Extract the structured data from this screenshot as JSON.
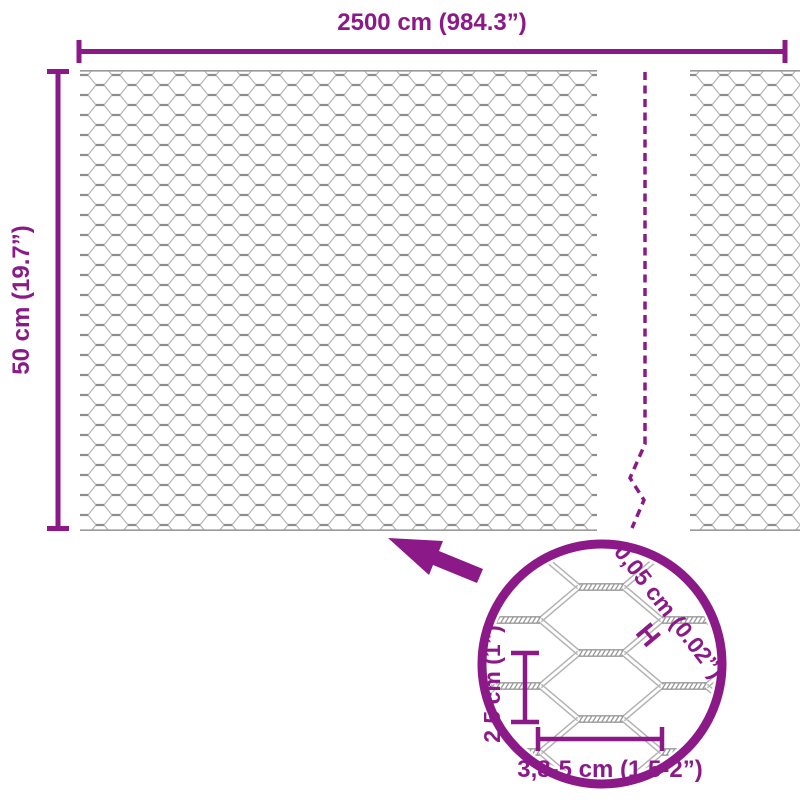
{
  "colors": {
    "accent": "#8B1A88",
    "mesh_light": "#b7b7b7",
    "mesh_dark": "#8d8d8d",
    "background": "#ffffff"
  },
  "overall": {
    "width_label": "2500 cm (984.3”)",
    "height_label": "50 cm (19.7”)"
  },
  "detail": {
    "wire_thickness_label": "0,05 cm (0.02”)",
    "wire_thickness_symbol": "H",
    "mesh_pitch_vertical_label": "2,5 cm (1”)",
    "mesh_pitch_horizontal_label": "3,8-5 cm (1.5-2”)"
  }
}
